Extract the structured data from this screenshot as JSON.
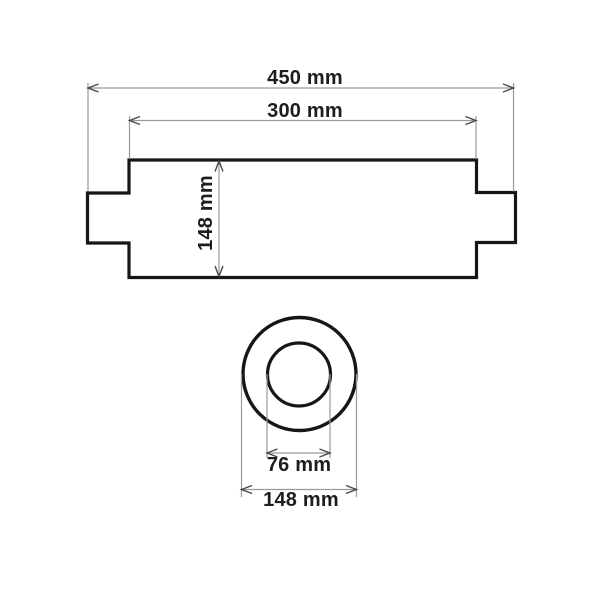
{
  "diagram": {
    "colors": {
      "background": "#ffffff",
      "outline": "#161616",
      "dimension_line": "#9a9a9a",
      "arrow": "#4a4a4a",
      "label_text": "#1d1d1d"
    },
    "top_view": {
      "overall_length_label": "450 mm",
      "body_length_label": "300 mm",
      "body_height_label": "148 mm"
    },
    "end_view": {
      "inner_diameter_label": "76 mm",
      "outer_diameter_label": "148 mm"
    }
  }
}
